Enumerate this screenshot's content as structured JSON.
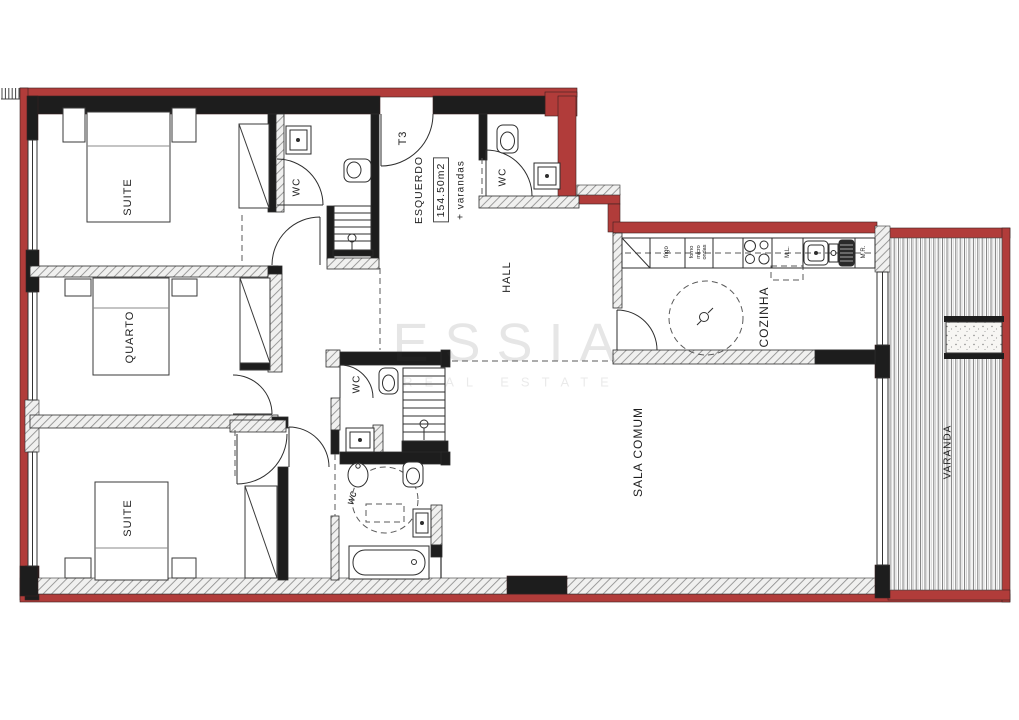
{
  "plan": {
    "title_block": {
      "unit": "T3",
      "side": "ESQUERDO",
      "area": "154.50m2",
      "area_note": "+ varandas"
    },
    "rooms": {
      "suite_top": "SUITE",
      "quarto": "QUARTO",
      "suite_bottom": "SUITE",
      "wc_suite": "WC",
      "wc_entrance": "WC",
      "wc_middle": "WC",
      "wc_bath": "wc",
      "hall": "HALL",
      "kitchen": "COZINHA",
      "living": "SALA COMUM",
      "balcony": "VARANDA"
    },
    "kitchen_labels": {
      "fridge": "frigo",
      "oven": "forno\nmicro\nondas",
      "dishwasher": "M.L.",
      "washer": "M.R."
    },
    "watermark": {
      "brand": "ESSIA",
      "tagline": "REAL ESTATE"
    },
    "colors": {
      "exterior_red": "#b13c3a",
      "wall_black": "#1d1d1d"
    }
  }
}
